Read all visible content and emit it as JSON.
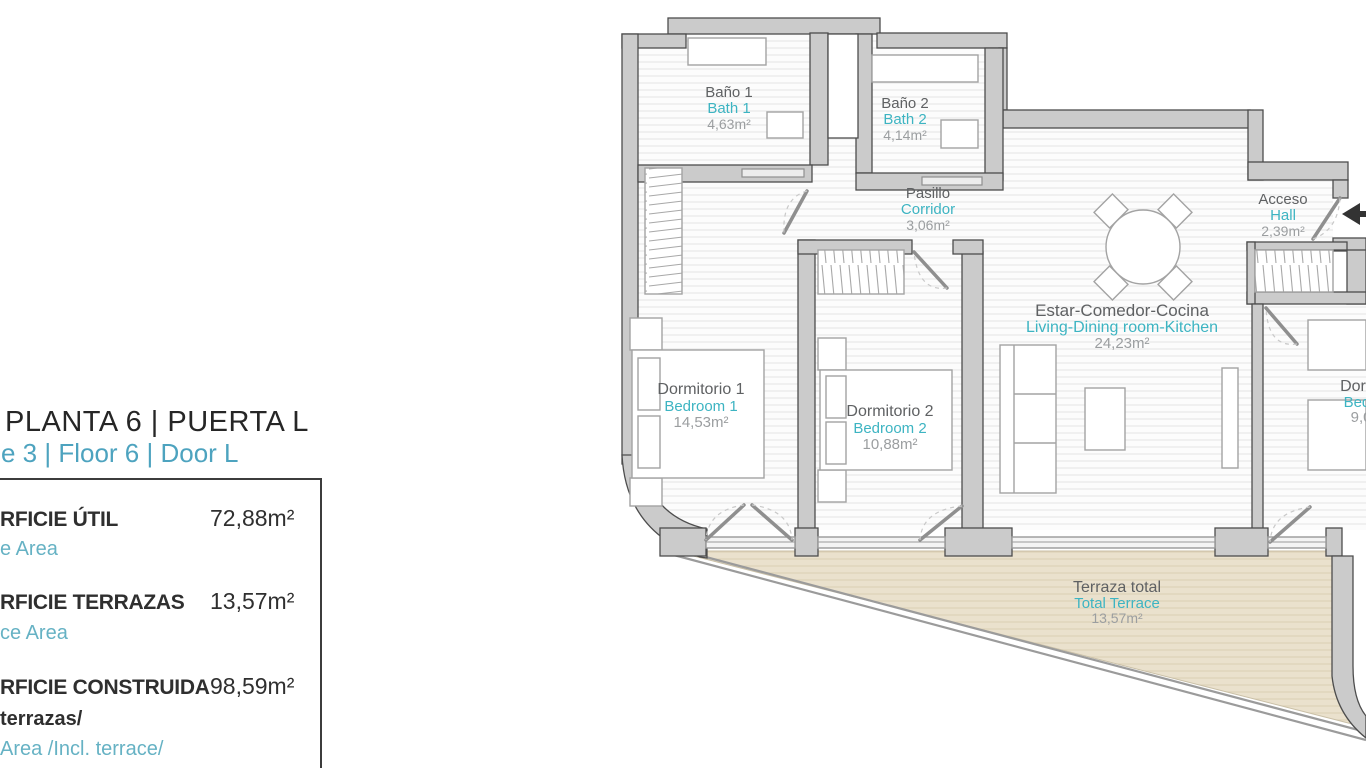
{
  "colors": {
    "accent_teal": "#3db4c2",
    "panel_teal": "#4da3bf",
    "wall_gray": "#cbcbcb",
    "terrace_beige": "#eae1cd"
  },
  "panel": {
    "title": "PLANTA 6 | PUERTA L",
    "subtitle": "e 3 | Floor 6 | Door L",
    "rows": [
      {
        "label": "RFICIE ÚTIL",
        "sublabel": "e Area",
        "value": "72,88m²"
      },
      {
        "label": "RFICIE TERRAZAS",
        "sublabel": "ce Area",
        "value": "13,57m²"
      },
      {
        "label": "RFICIE CONSTRUIDA",
        "label_line2": "terrazas/",
        "sublabel": "Area /Incl. terrace/",
        "value": "98,59m²"
      }
    ]
  },
  "plan": {
    "rooms": [
      {
        "name": "Baño 1",
        "name_en": "Bath 1",
        "area": "4,63m²"
      },
      {
        "name": "Baño 2",
        "name_en": "Bath 2",
        "area": "4,14m²"
      },
      {
        "name": "Pasillo",
        "name_en": "Corridor",
        "area": "3,06m²"
      },
      {
        "name": "Acceso",
        "name_en": "Hall",
        "area": "2,39m²"
      },
      {
        "name": "Estar-Comedor-Cocina",
        "name_en": "Living-Dining room-Kitchen",
        "area": "24,23m²"
      },
      {
        "name": "Dormitorio 1",
        "name_en": "Bedroom 1",
        "area": "14,53m²"
      },
      {
        "name": "Dormitorio 2",
        "name_en": "Bedroom 2",
        "area": "10,88m²"
      },
      {
        "name": "Dormitorio",
        "name_en": "Bedroom",
        "area": "9,02m²"
      },
      {
        "name": "Terraza total",
        "name_en": "Total Terrace",
        "area": "13,57m²"
      }
    ]
  }
}
